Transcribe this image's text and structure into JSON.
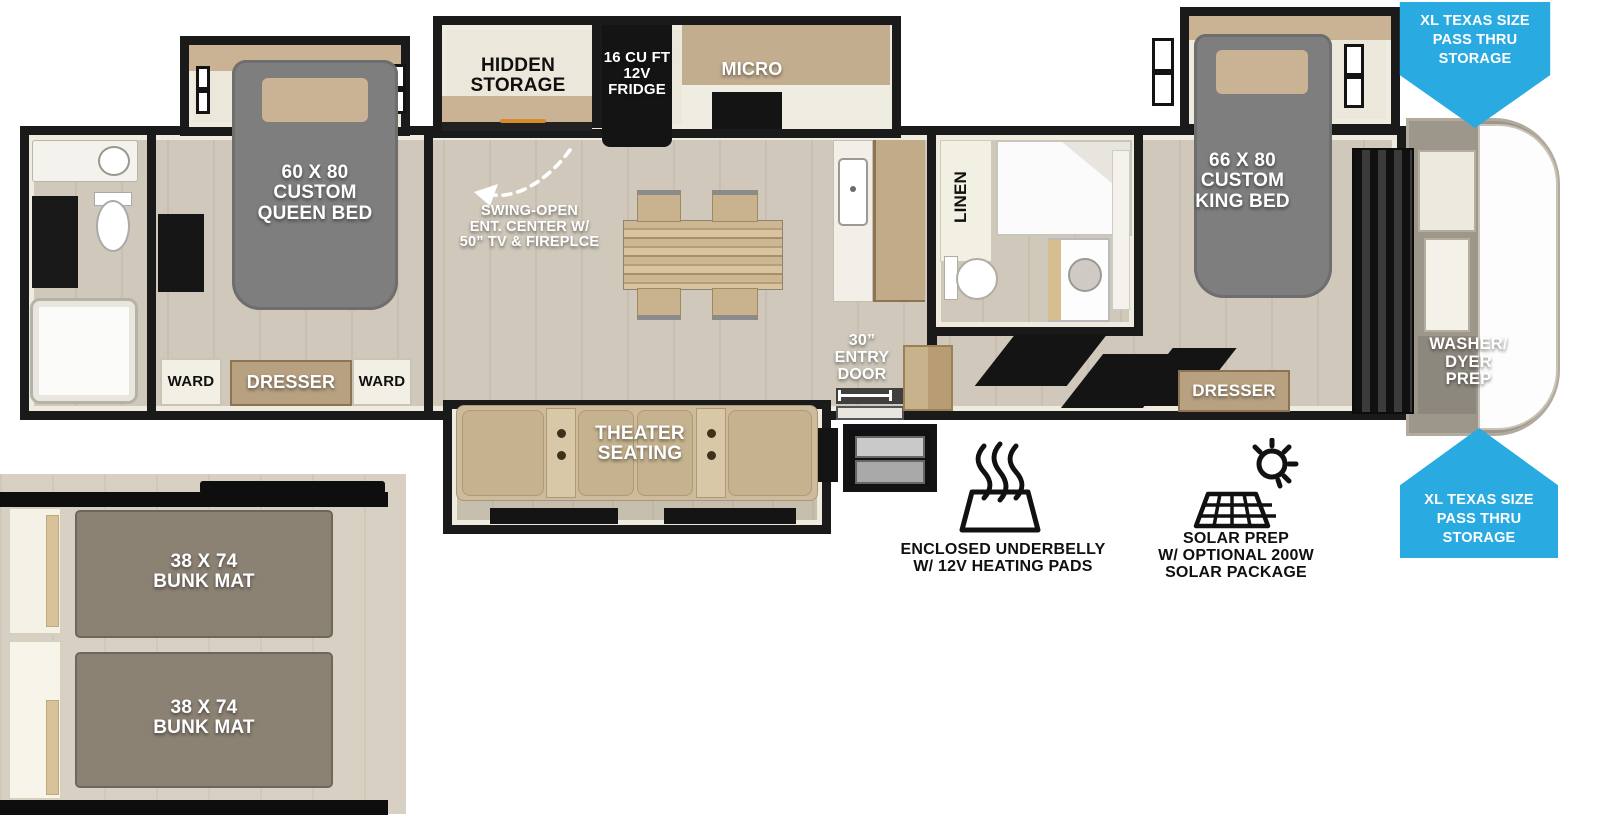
{
  "colors": {
    "accent_blue": "#29abe2",
    "wall_black": "#1a1a1a",
    "floor_tan": "#d0c9bb",
    "bed_gray": "#7e7e7e",
    "wood_tan": "#c2ad8e",
    "seat_tan": "#c8b593",
    "mat_taupe": "#8c8274"
  },
  "callouts": {
    "pass_thru_top": "XL TEXAS SIZE\nPASS THRU\nSTORAGE",
    "pass_thru_bottom": "XL TEXAS SIZE\nPASS THRU\nSTORAGE",
    "swing_open": "SWING-OPEN\nENT. CENTER W/\n50” TV & FIREPLCE",
    "entry_door": "30”\nENTRY\nDOOR"
  },
  "rooms": {
    "queen_bedroom": {
      "bed": "60 X 80\nCUSTOM\nQUEEN BED",
      "ward_left": "WARD",
      "dresser": "DRESSER",
      "ward_right": "WARD"
    },
    "kitchen": {
      "hidden_storage": "HIDDEN\nSTORAGE",
      "fridge": "16 CU FT\n12V\nFRIDGE",
      "micro": "MICRO"
    },
    "living": {
      "theater_seating": "THEATER\nSEATING"
    },
    "mid_bath": {
      "linen": "LINEN"
    },
    "king_bedroom": {
      "bed": "66 X 80\nCUSTOM\nKING BED",
      "dresser": "DRESSER"
    },
    "front_cap": {
      "washer_dryer": "WASHER/\nDYER\nPREP"
    },
    "bunk_room": {
      "bunk_top": "38 X 74\nBUNK MAT",
      "bunk_bottom": "38 X 74\nBUNK MAT"
    }
  },
  "features": [
    {
      "icon": "underbelly-heat-icon",
      "label": "ENCLOSED UNDERBELLY\nW/ 12V HEATING PADS"
    },
    {
      "icon": "solar-prep-icon",
      "label": "SOLAR PREP\nW/ OPTIONAL 200W\nSOLAR PACKAGE"
    }
  ]
}
